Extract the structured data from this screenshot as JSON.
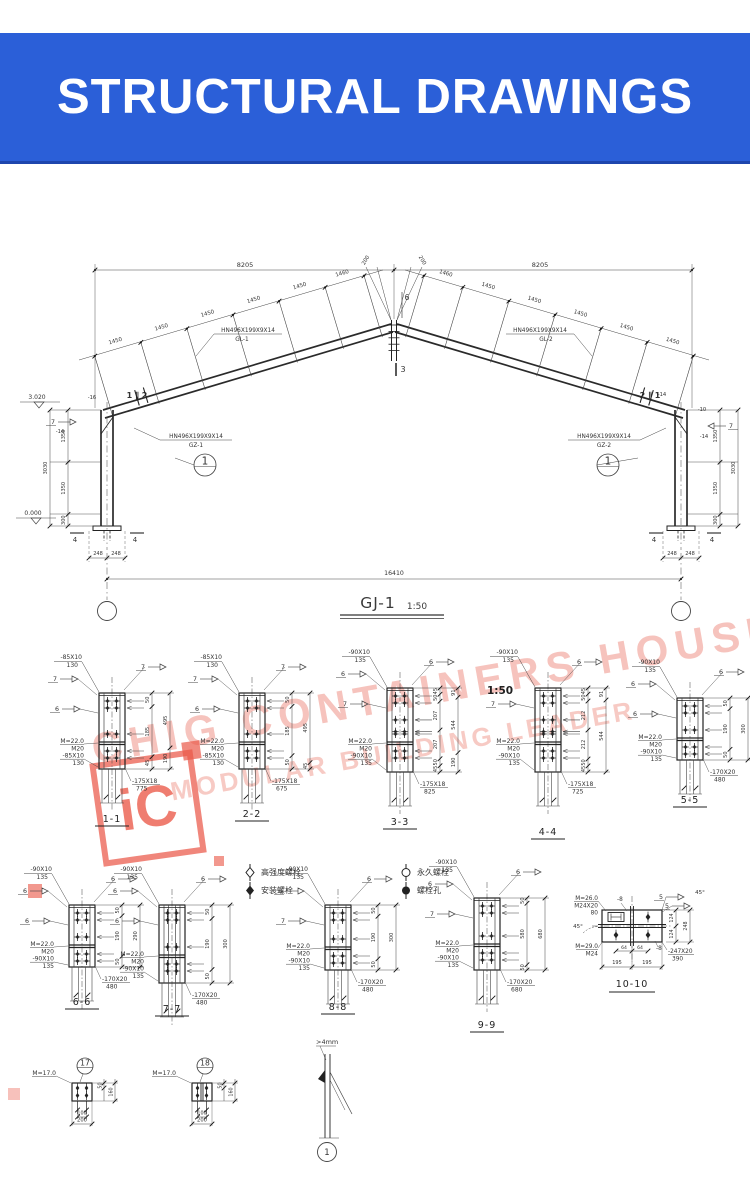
{
  "banner": {
    "title": "STRUCTURAL DRAWINGS",
    "bg": "#2b5fd8",
    "fg": "#ffffff"
  },
  "main_drawing": {
    "title": "GJ-1",
    "scale": "1:50",
    "dims": {
      "span_left": "8205",
      "span_right": "8205",
      "overall": "16410",
      "purlin": [
        "1450",
        "1450",
        "1450",
        "1450",
        "1450",
        "1460"
      ],
      "ridge_offset": "200",
      "column_heights": [
        "1350",
        "1350",
        "300"
      ],
      "column_total": "3030",
      "base_pair": [
        "248",
        "248"
      ],
      "elev_eave": "3.020",
      "elev_base": "0.000"
    },
    "labels": {
      "rafter_left": [
        "HN496X199X9X14",
        "GL-1"
      ],
      "rafter_right": [
        "HN496X199X9X14",
        "GL-2"
      ],
      "column_left": [
        "HN496X199X9X14",
        "GZ-1"
      ],
      "column_right": [
        "HN496X199X9X14",
        "GZ-2"
      ],
      "eave_left": "1 ∥ 2",
      "eave_right": "2 ∥ 1",
      "apex_section": "6",
      "ridge_section": "3",
      "base_section": "4",
      "callout": "1",
      "haunch_left": [
        "-16",
        "7",
        "-14"
      ],
      "haunch_right": [
        "-14",
        "-10",
        "7",
        "-14"
      ]
    }
  },
  "legend": {
    "items": [
      {
        "symbol": "diamond-open",
        "label": "高强度螺栓"
      },
      {
        "symbol": "diamond-filled",
        "label": "安装螺栓"
      },
      {
        "symbol": "circle-open",
        "label": "永久螺栓"
      },
      {
        "symbol": "circle-filled",
        "label": "螺栓孔"
      }
    ]
  },
  "sections": [
    {
      "title": "1-1",
      "size_label": [
        "-85X10",
        "130"
      ],
      "bolt_label": [
        "M=22.0",
        "M20",
        "-85X10",
        "130"
      ],
      "plate_label": [
        "-175X18",
        "775"
      ],
      "dims_inner": [
        "50",
        "185",
        "45"
      ],
      "dims_outer": [
        "495",
        "190"
      ],
      "flags": [
        "7",
        "7",
        "6"
      ]
    },
    {
      "title": "2-2",
      "size_label": [
        "-85X10",
        "130"
      ],
      "bolt_label": [
        "M=22.0",
        "M20",
        "-85X10",
        "130"
      ],
      "plate_label": [
        "-175X18",
        "675"
      ],
      "dims_inner": [
        "50",
        "185",
        "50"
      ],
      "dims_outer": [
        "495",
        "45"
      ],
      "flags": [
        "7",
        "7",
        "6"
      ]
    },
    {
      "title": "3-3",
      "size_label": [
        "-90X10",
        "135"
      ],
      "bolt_label": [
        "M=22.0",
        "M20",
        "-90X10",
        "135"
      ],
      "plate_label": [
        "-175X18",
        "825"
      ],
      "dims_inner": [
        "45",
        "50",
        "207",
        "207",
        "50",
        "45"
      ],
      "dims_outer": [
        "91",
        "544",
        "190"
      ],
      "flags": [
        "6",
        "6",
        "7"
      ]
    },
    {
      "title": "4-4",
      "size_label": [
        "-90X10",
        "135"
      ],
      "bolt_label": [
        "M=22.0",
        "M20",
        "-90X10",
        "135"
      ],
      "plate_label": [
        "-175X18",
        "725"
      ],
      "dims_inner": [
        "45",
        "50",
        "212",
        "212",
        "50",
        "45"
      ],
      "dims_outer": [
        "91",
        "544"
      ],
      "flags": [
        null,
        "6",
        "7"
      ],
      "note": "1:50"
    },
    {
      "title": "5-5",
      "size_label": [
        "-90X10",
        "135"
      ],
      "bolt_label": [
        "M=22.0",
        "M20",
        "-90X10",
        "135"
      ],
      "plate_label": [
        "-170X20",
        "480"
      ],
      "dims_inner": [
        "50",
        "190",
        "50"
      ],
      "dims_outer": [
        "300"
      ],
      "flags": [
        "6",
        "6",
        "6"
      ]
    },
    {
      "title": "6-6",
      "size_label": [
        "-90X10",
        "135"
      ],
      "bolt_label": [
        "M=22.0",
        "M20",
        "-90X10",
        "135"
      ],
      "plate_label": [
        "-170X20",
        "480"
      ],
      "dims_inner": [
        "50",
        "190",
        "50"
      ],
      "dims_outer": [
        "290"
      ],
      "flags": [
        "6",
        "6",
        "6"
      ]
    },
    {
      "title": "7-7",
      "size_label": [
        "-90X10",
        "135"
      ],
      "bolt_label": [
        "M=22.0",
        "M20",
        "-90X10",
        "135"
      ],
      "plate_label": [
        "-170X20",
        "480"
      ],
      "dims_inner": [
        "50",
        "190",
        "50"
      ],
      "dims_outer": [
        "300"
      ],
      "flags": [
        "6",
        "6",
        "6"
      ]
    },
    {
      "title": "8-8",
      "size_label": [
        "-90X10",
        "135"
      ],
      "bolt_label": [
        "M=22.0",
        "M20",
        "-90X10",
        "135"
      ],
      "plate_label": [
        "-170X20",
        "480"
      ],
      "dims_inner": [
        "50",
        "190",
        "50"
      ],
      "dims_outer": [
        "300"
      ],
      "flags": [
        "6",
        "6",
        "7"
      ]
    },
    {
      "title": "9-9",
      "size_label": [
        "-90X10",
        "135"
      ],
      "bolt_label": [
        "M=22.0",
        "M20",
        "-90X10",
        "135"
      ],
      "plate_label": [
        "-170X20",
        "680"
      ],
      "dims_inner": [
        "50",
        "580",
        "50"
      ],
      "dims_outer": [
        "680"
      ],
      "flags": [
        "6",
        "6",
        "7"
      ]
    },
    {
      "title": "10-10",
      "anchor_label": [
        "M=26.0",
        "M24X20",
        "80"
      ],
      "anchor_label2": [
        "M=29.0",
        "M24"
      ],
      "plate_label": [
        "-247X20",
        "390"
      ],
      "plate_marks": [
        "-8",
        "-8"
      ],
      "weld_size": "5",
      "weld_angle": "45°",
      "dims_right_inner": [
        "124",
        "124"
      ],
      "dims_right_outer": [
        "248"
      ],
      "dims_bottom": [
        "195",
        "195"
      ],
      "dims_bottom_small": [
        "64",
        "64"
      ]
    }
  ],
  "footer": {
    "details": [
      {
        "callout": "17",
        "anchor_label": "M=17.0",
        "dim_top": "50",
        "dim_side": "160",
        "dim_inner": "100",
        "dim_outer": "200"
      },
      {
        "callout": "18",
        "anchor_label": "M=17.0",
        "dim_top": "50",
        "dim_side": "160",
        "dim_inner": "100",
        "dim_outer": "200"
      }
    ],
    "weld_detail": {
      "note": ">4mm",
      "callout": "1"
    }
  },
  "watermark": {
    "line1": "CHIG CONTAINERS HOUSE",
    "line2": "MODULAR BUILDING LEADER",
    "logo_text": "iC",
    "color": "#f09e94",
    "accent": "#ea5848"
  }
}
